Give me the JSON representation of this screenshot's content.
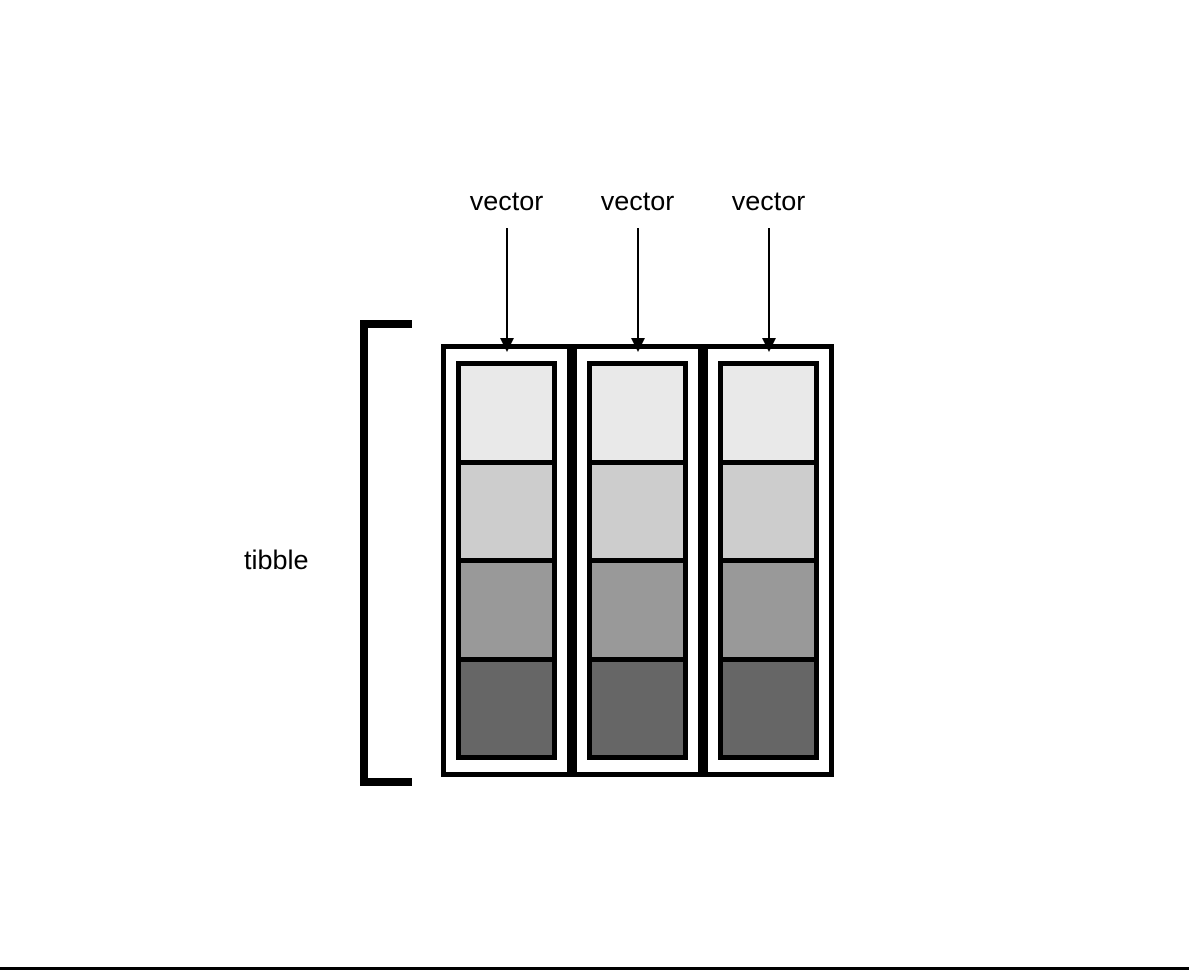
{
  "diagram": {
    "row_label": "tibble",
    "vector_labels": [
      "vector",
      "vector",
      "vector"
    ],
    "grid": {
      "columns": 3,
      "rows": 4
    },
    "cell_colors": [
      "#E9E9E9",
      "#CDCDCD",
      "#999999",
      "#666666"
    ],
    "border_color": "#000000",
    "background_color": "#FFFFFF",
    "text_color": "#000000"
  }
}
